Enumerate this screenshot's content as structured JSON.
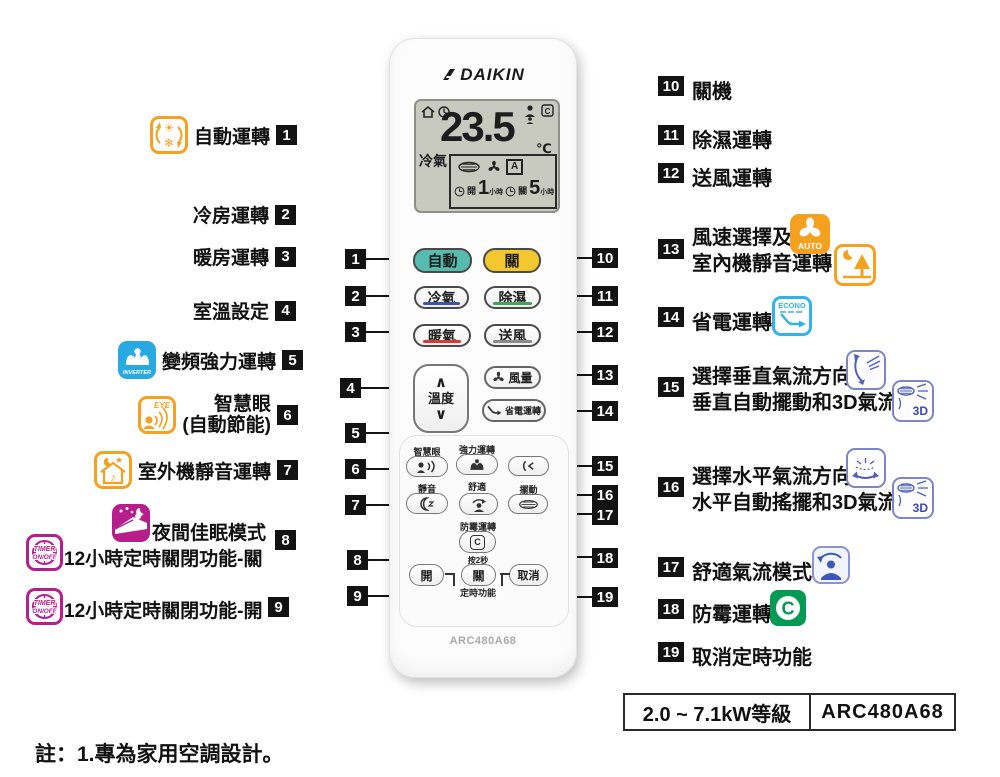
{
  "figure": {
    "note": "註：1.專為家用空調設計。",
    "rating_label": "2.0 ~ 7.1kW等級",
    "model_label": "ARC480A68"
  },
  "remote": {
    "brand": "DAIKIN",
    "model": "ARC480A68",
    "display": {
      "mode": "冷氣",
      "temperature": "23.5",
      "unit": "℃",
      "fan_auto": "A",
      "timer_on_label": "開",
      "timer_on_hours": "1",
      "timer_off_label": "關",
      "timer_off_hours": "5",
      "hour_unit": "小時"
    },
    "buttons": {
      "auto": "自動",
      "off": "關",
      "cool": "冷氣",
      "dry": "除濕",
      "heat": "暖氣",
      "fan_only": "送風",
      "temp": "溫度",
      "up_glyph": "∧",
      "down_glyph": "∨",
      "fan_speed": "風量",
      "econo": "省電運轉",
      "smart_eye": "智慧眼",
      "powerful": "強力運轉",
      "quiet": "靜音",
      "comfort": "舒適",
      "swing": "擺動",
      "mold_proof": "防霉運轉",
      "mold_icon": "C",
      "press_2s": "按2秒",
      "timer_on": "開",
      "timer_off": "關",
      "timer_cancel": "取消",
      "timer_group": "定時功能"
    }
  },
  "icons": {
    "inverter": "INVERTER",
    "eye": "EYE",
    "timer1": "TIMER",
    "timer2": "ON/OFF",
    "auto_fan": "AUTO",
    "econo": "ECONO",
    "threed": "3D",
    "mold": "C"
  },
  "left_labels": [
    {
      "num": "1",
      "text": "自動運轉"
    },
    {
      "num": "2",
      "text": "冷房運轉"
    },
    {
      "num": "3",
      "text": "暖房運轉"
    },
    {
      "num": "4",
      "text": "室溫設定"
    },
    {
      "num": "5",
      "text": "變頻強力運轉"
    },
    {
      "num": "6",
      "line1": "智慧眼",
      "line2": "(自動節能)"
    },
    {
      "num": "7",
      "text": "室外機靜音運轉"
    },
    {
      "num": "8",
      "line1": "夜間佳眠模式",
      "line2": "12小時定時關閉功能-關"
    },
    {
      "num": "9",
      "text": "12小時定時關閉功能-開"
    }
  ],
  "right_labels": [
    {
      "num": "10",
      "text": "關機"
    },
    {
      "num": "11",
      "text": "除濕運轉"
    },
    {
      "num": "12",
      "text": "送風運轉"
    },
    {
      "num": "13",
      "line1": "風速選擇及",
      "line2": "室內機靜音運轉"
    },
    {
      "num": "14",
      "text": "省電運轉"
    },
    {
      "num": "15",
      "line1": "選擇垂直氣流方向",
      "line2": "垂直自動擺動和3D氣流"
    },
    {
      "num": "16",
      "line1": "選擇水平氣流方向",
      "line2": "水平自動搖擺和3D氣流"
    },
    {
      "num": "17",
      "text": "舒適氣流模式"
    },
    {
      "num": "18",
      "text": "防霉運轉"
    },
    {
      "num": "19",
      "text": "取消定時功能"
    }
  ],
  "colors": {
    "auto_button": "#57bcae",
    "off_button": "#f3c72f",
    "cool_underline": "#3a55a5",
    "dry_underline": "#3fa457",
    "heat_underline": "#d63c30",
    "fan_underline": "#8a8a8a",
    "orange_icon": "#f5a01e",
    "blue_icon": "#29a9e1",
    "magenta_icon": "#b61e8c",
    "cyan_icon": "#2fb4e9",
    "periwinkle_icon": "#7b86c8",
    "green_icon": "#009a55",
    "callout_bg": "#131313",
    "lcd_bg": "#c8c9bf"
  }
}
